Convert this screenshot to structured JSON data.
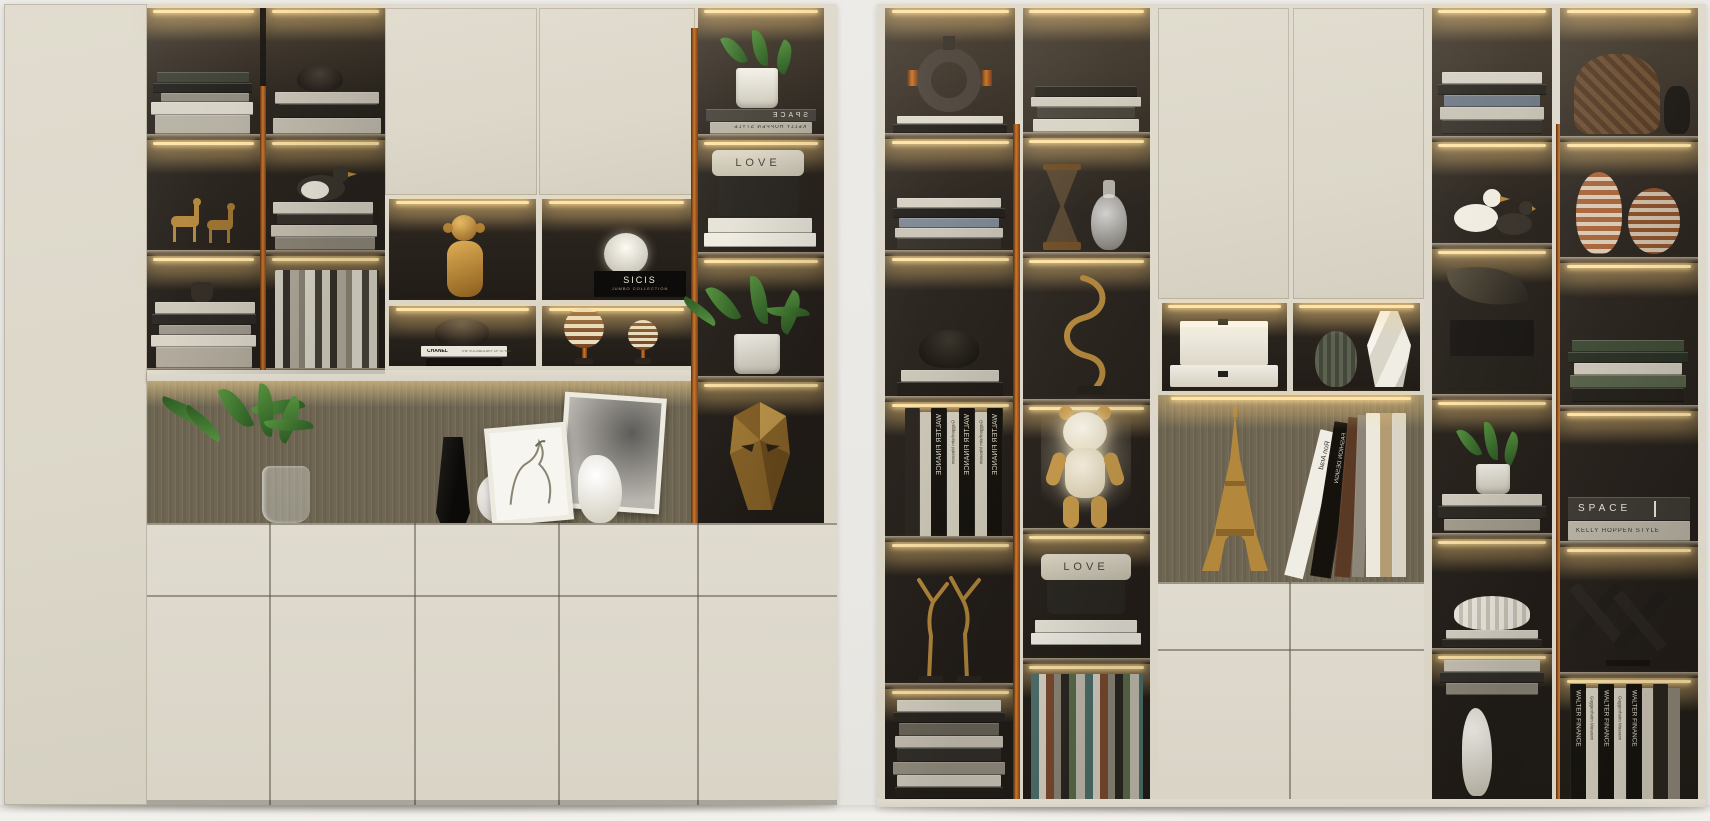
{
  "scene": {
    "title": "Two modern built-in display bookshelf cabinets, 3D interior render",
    "background": {
      "wall": "#eae8e4",
      "floor": "#f2f0ec"
    },
    "palette": {
      "cream": "#ddd8cb",
      "interior_dark": "#2b251f",
      "copper_handle": "#b4651f",
      "led_glow": "#ffeab6",
      "niche_back": "#6f6753",
      "brass": "#b3873c"
    },
    "labels": {
      "space": "SPACE",
      "kelly_hoppen": "KELLY HOPPEN STYLE",
      "love": "LOVE",
      "sicis": "SICIS",
      "jumbo_collection": "JUMBO COLLECTION",
      "chanel": "CHANEL",
      "chanel_subtitle": "THE VOCABULARY OF STYLE",
      "walter_finance": "WALTER FINANCE",
      "guggenheim": "Guggenheim Museum",
      "ron_arad": "Ron Arad",
      "fashion_design": "FASHION DESIGN"
    },
    "left_cabinet": {
      "structure": [
        "tall wardrobe door",
        "two glass display columns with copper handle",
        "two top doors",
        "2x2 lit display grid",
        "illuminated niche with ribbed back panel",
        "five drawers",
        "five base doors"
      ],
      "decor": [
        "stacked books",
        "brass deer figurines",
        "dark bowl",
        "ceramic bird",
        "vertical book row",
        "brass monkey figurine",
        "white pumpkin lamp",
        "SICIS JUMBO COLLECTION box",
        "CHANEL book stack",
        "striped candle spheres",
        "potted plant in glass vase",
        "black faceted vase",
        "white carved vase",
        "two horse artwork frames",
        "white gourd vase",
        "plant pots",
        "LOVE storage box",
        "brass mask sculpture"
      ]
    },
    "right_cabinet": {
      "structure": [
        "four glass display columns with copper handles",
        "two top doors",
        "two lit display cells",
        "illuminated niche",
        "two drawers",
        "two base doors"
      ],
      "decor": [
        "ring sculpture",
        "book stacks",
        "dark bowl",
        "WALTER FINANCE Guggenheim Museum book set",
        "brass dancer figurines",
        "hourglass",
        "glass decanter",
        "brass swirl sculpture",
        "glowing bear lamp",
        "LOVE storage box",
        "white storage boxes",
        "olive pleated vase",
        "white faceted vase",
        "brass Eiffel Tower model",
        "leaning design books",
        "bird figurines",
        "black gift boxes",
        "potted plant",
        "fluted white bowl",
        "wicker basket",
        "striped gourd vases",
        "cross sculpture",
        "ceramic vases"
      ]
    }
  }
}
